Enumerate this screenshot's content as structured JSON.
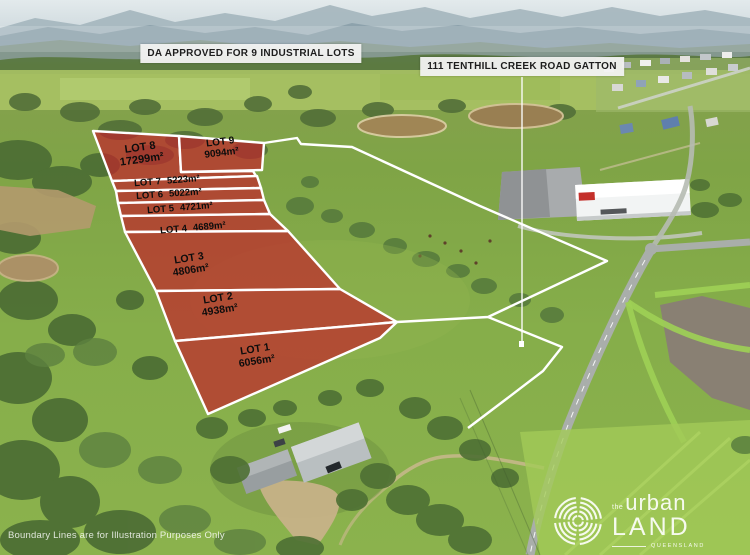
{
  "header_callouts": {
    "da_approval": "DA APPROVED FOR 9 INDUSTRIAL LOTS",
    "address": "111 TENTHILL CREEK ROAD GATTON"
  },
  "lots": [
    {
      "id": "LOT 1",
      "area": "6056m²"
    },
    {
      "id": "LOT 2",
      "area": "4938m²"
    },
    {
      "id": "LOT 3",
      "area": "4806m²"
    },
    {
      "id": "LOT 4",
      "area": "4689m²"
    },
    {
      "id": "LOT 5",
      "area": "4721m²"
    },
    {
      "id": "LOT 6",
      "area": "5022m²"
    },
    {
      "id": "LOT 7",
      "area": "5223m²"
    },
    {
      "id": "LOT 8",
      "area": "17299m²"
    },
    {
      "id": "LOT 9",
      "area": "9094m²"
    }
  ],
  "footer": {
    "disclaimer": "Boundary Lines are for Illustration Purposes Only"
  },
  "logo": {
    "prefix": "the",
    "word1": "urban",
    "word2": "LAND",
    "region": "QUEENSLAND"
  },
  "colors": {
    "lot_fill": "#c2242b",
    "boundary_line": "#ffffff",
    "callout_bg": "#f2f2f2",
    "callout_text": "#1d1d1d"
  }
}
